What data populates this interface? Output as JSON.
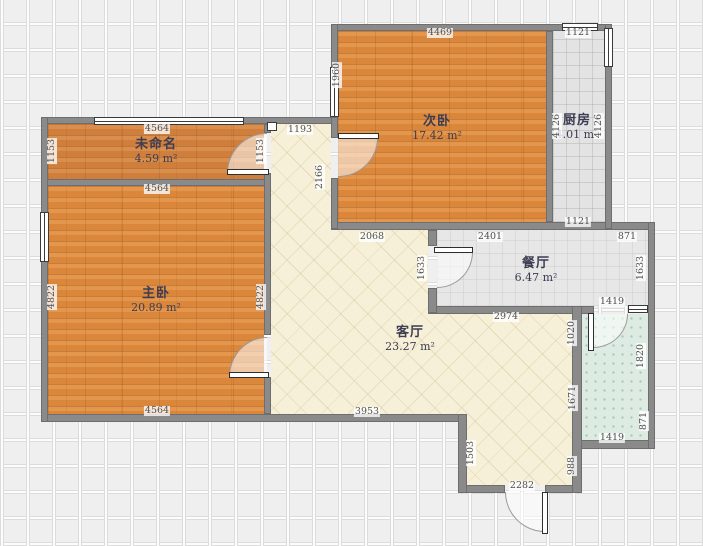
{
  "plan": {
    "unit": "mm",
    "rooms": [
      {
        "name": "未命名",
        "area": "4.59 m²"
      },
      {
        "name": "主卧",
        "area": "20.89 m²"
      },
      {
        "name": "次卧",
        "area": "17.42 m²"
      },
      {
        "name": "厨房",
        "area": "4.01 m²"
      },
      {
        "name": "餐厅",
        "area": "6.47 m²"
      },
      {
        "name": "客厅",
        "area": "23.27 m²"
      }
    ],
    "dimensions": [
      {
        "text": "4469",
        "x": 440,
        "y": 33
      },
      {
        "text": "1121",
        "x": 578,
        "y": 33
      },
      {
        "text": "1960",
        "x": 337,
        "y": 75,
        "v": true
      },
      {
        "text": "4126",
        "x": 557,
        "y": 126,
        "v": true
      },
      {
        "text": "4126",
        "x": 599,
        "y": 126,
        "v": true
      },
      {
        "text": "1121",
        "x": 578,
        "y": 222
      },
      {
        "text": "4564",
        "x": 157,
        "y": 129
      },
      {
        "text": "1153",
        "x": 52,
        "y": 151,
        "v": true
      },
      {
        "text": "1153",
        "x": 261,
        "y": 151,
        "v": true
      },
      {
        "text": "1193",
        "x": 300,
        "y": 130
      },
      {
        "text": "4564",
        "x": 157,
        "y": 189
      },
      {
        "text": "2166",
        "x": 320,
        "y": 177,
        "v": true
      },
      {
        "text": "2068",
        "x": 372,
        "y": 237
      },
      {
        "text": "2401",
        "x": 490,
        "y": 237
      },
      {
        "text": "871",
        "x": 627,
        "y": 237
      },
      {
        "text": "4822",
        "x": 52,
        "y": 297,
        "v": true
      },
      {
        "text": "4822",
        "x": 261,
        "y": 297,
        "v": true
      },
      {
        "text": "4564",
        "x": 157,
        "y": 411
      },
      {
        "text": "1633",
        "x": 422,
        "y": 268,
        "v": true
      },
      {
        "text": "1633",
        "x": 641,
        "y": 268,
        "v": true
      },
      {
        "text": "1419",
        "x": 612,
        "y": 302
      },
      {
        "text": "2974",
        "x": 506,
        "y": 317
      },
      {
        "text": "1020",
        "x": 572,
        "y": 333,
        "v": true
      },
      {
        "text": "1820",
        "x": 641,
        "y": 356,
        "v": true
      },
      {
        "text": "1671",
        "x": 573,
        "y": 398,
        "v": true
      },
      {
        "text": "871",
        "x": 644,
        "y": 421,
        "v": true
      },
      {
        "text": "988",
        "x": 572,
        "y": 466,
        "v": true
      },
      {
        "text": "1419",
        "x": 612,
        "y": 438
      },
      {
        "text": "3953",
        "x": 367,
        "y": 412
      },
      {
        "text": "1503",
        "x": 471,
        "y": 453,
        "v": true
      },
      {
        "text": "2282",
        "x": 522,
        "y": 486
      }
    ],
    "colors": {
      "wood": "#df8a3f",
      "wood_dark": "#d2813f",
      "living": "#f7f0d8",
      "kitchen": "#e3e3e3",
      "dining": "#e7e7e7",
      "bath": "#ddebe3",
      "wall": "#8a8a8a",
      "grid_bg": "#efefef"
    }
  }
}
